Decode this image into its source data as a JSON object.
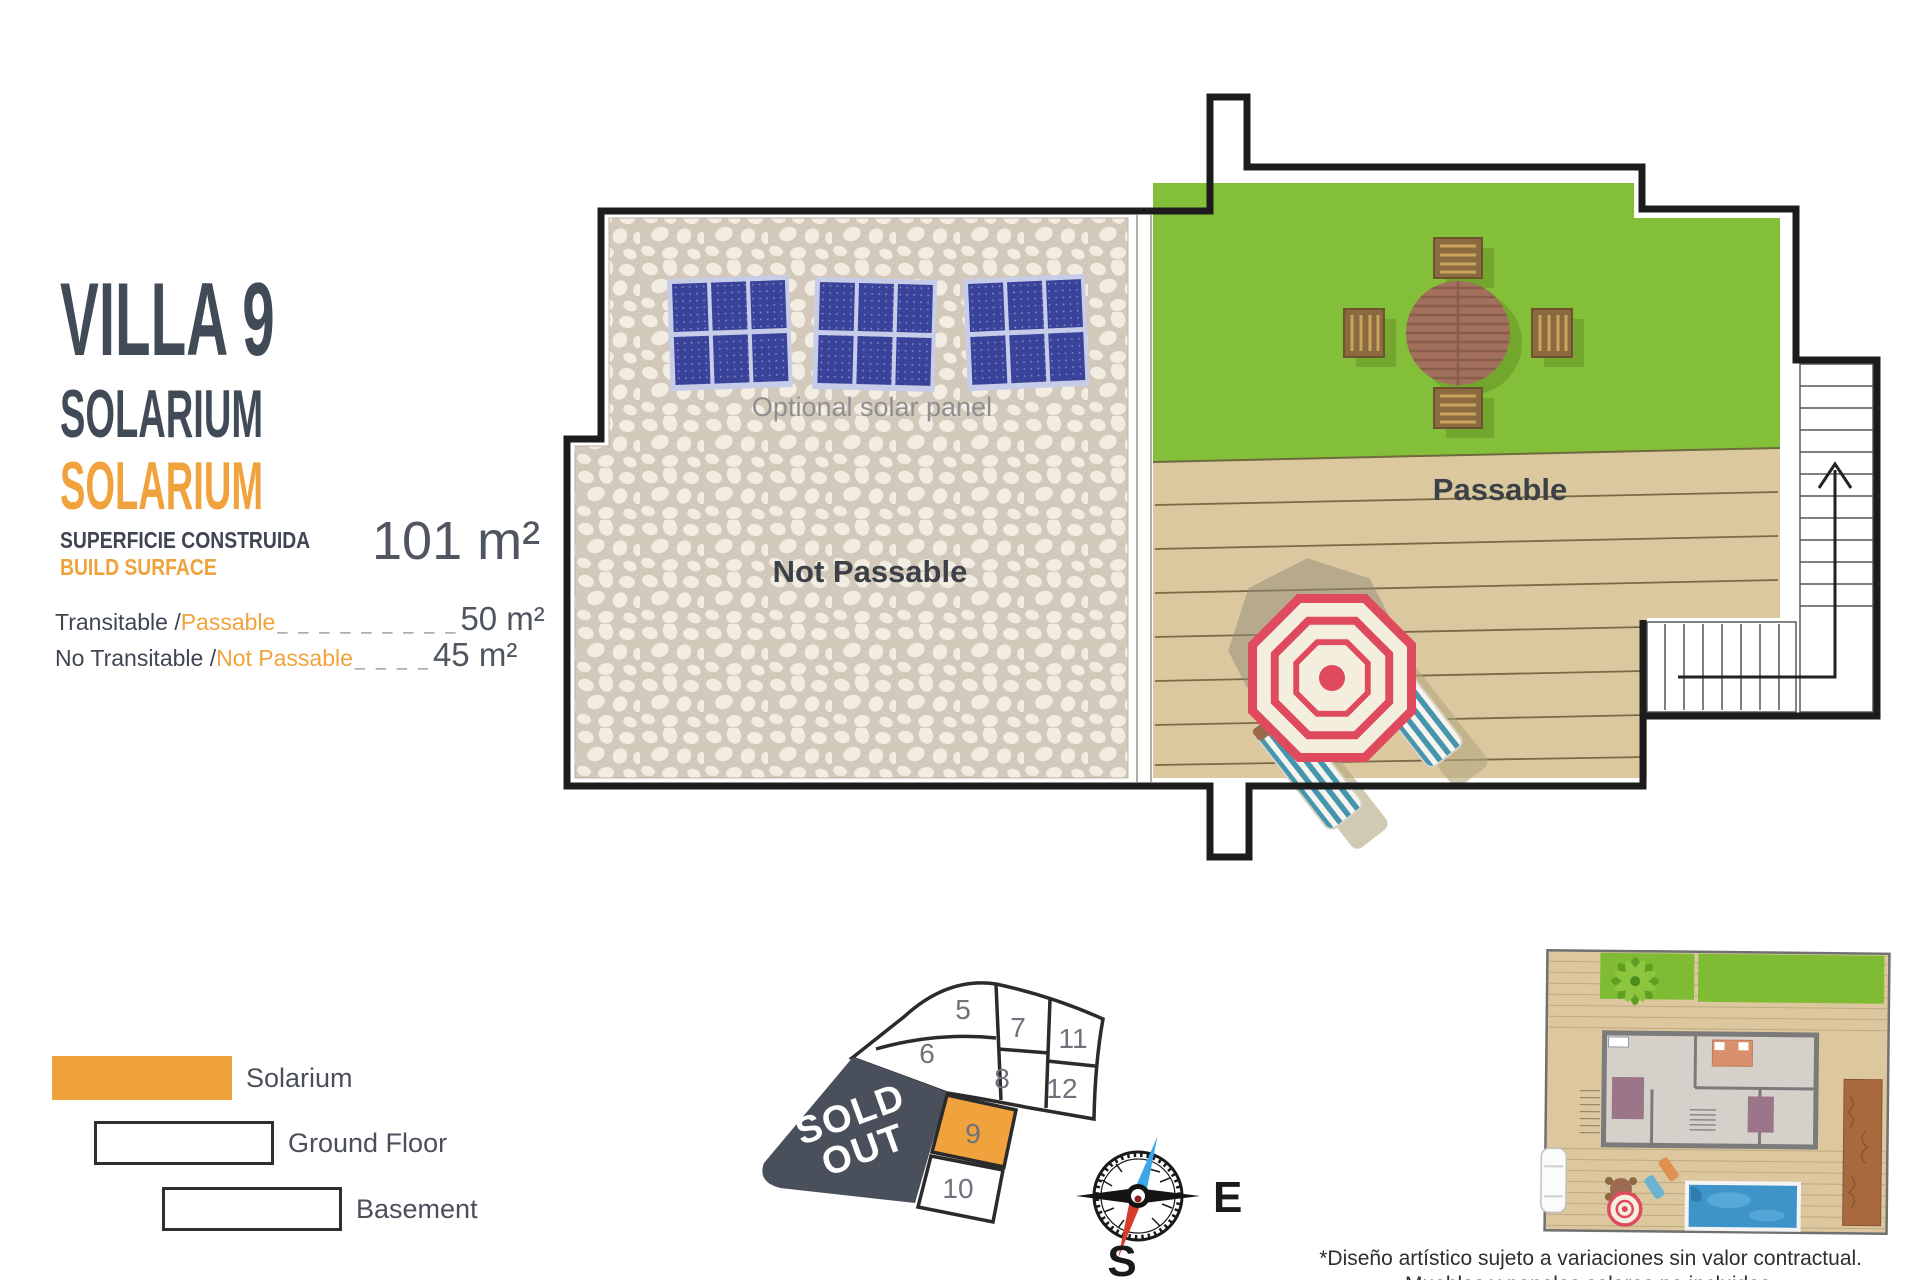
{
  "header": {
    "villa_title": "VILLA 9",
    "floor_name_en": "SOLARIUM",
    "floor_name_es": "SOLARIUM"
  },
  "surface": {
    "label_es": "SUPERFICIE CONSTRUIDA",
    "label_en": "BUILD SURFACE",
    "total": "101 m²"
  },
  "measurements": [
    {
      "prefix": "Transitable / ",
      "term": "Passable",
      "dashes": "_ _ _ _ _ _ _ _ _",
      "value": "50 m²"
    },
    {
      "prefix": "No Transitable / ",
      "term": "Not Passable",
      "dashes": "_ _ _ _",
      "value": "45 m²"
    }
  ],
  "legend": {
    "items": [
      {
        "label": "Solarium"
      },
      {
        "label": "Ground Floor"
      },
      {
        "label": "Basement"
      }
    ]
  },
  "plan": {
    "not_passable_label": "Not Passable",
    "passable_label": "Passable",
    "solar_panel_note": "Optional solar panel"
  },
  "plot_map": {
    "sold_out_line1": "SOLD",
    "sold_out_line2": "OUT",
    "highlighted_cell": "9",
    "cells": {
      "c5": "5",
      "c6": "6",
      "c7": "7",
      "c8": "8",
      "c11": "11",
      "c12": "12",
      "c9": "9",
      "c10": "10"
    }
  },
  "compass": {
    "east": "E",
    "south": "S"
  },
  "footnote": {
    "line1": "*Diseño artístico sujeto a variaciones sin valor contractual.",
    "line2": "Muebles y paneles solares no incluidos."
  },
  "colors": {
    "accent_orange": "#F0A23C",
    "dark_text": "#3F4652",
    "muted_text": "#8F8F8F",
    "grass_green": "#84BF3A",
    "deck_tan": "#DCC89E",
    "stone_bg": "#D2C9BA",
    "pebble": "#F2ECE3",
    "panel_blue": "#39439A",
    "sold_out": "#4A505B",
    "umbrella_red": "#E04A5E",
    "outline_black": "#1C1C1C"
  }
}
